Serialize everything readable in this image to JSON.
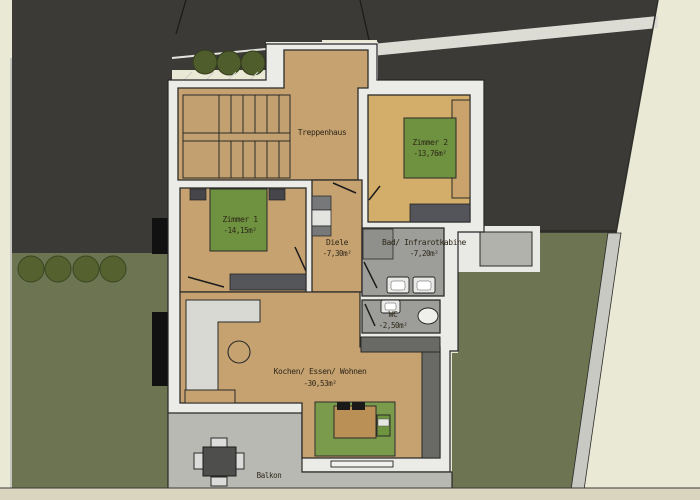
{
  "plan": {
    "type": "architectural floor plan, top-down site view",
    "rooms": [
      {
        "name": "Treppenhaus",
        "area": ""
      },
      {
        "name": "Zimmer 2",
        "area": "-13,76m²"
      },
      {
        "name": "Zimmer 1",
        "area": "-14,15m²"
      },
      {
        "name": "Diele",
        "area": "-7,30m²"
      },
      {
        "name": "Bad/ Infrarotkabine",
        "area": "-7,20m²"
      },
      {
        "name": "WC",
        "area": "-2,50m²"
      },
      {
        "name": "Kochen/ Essen/ Wohnen",
        "area": "-30,53m²"
      },
      {
        "name": "Balkon",
        "area": ""
      }
    ],
    "colors": {
      "background": "#eae9d5",
      "neighbor_building": "#3b3a36",
      "lawn": "#6c7452",
      "tree": "#4f5c2c",
      "wood_floor": "#c6a271",
      "bedroom2_floor": "#d3ae6a",
      "bath_gray": "#9d9e9a",
      "wall_white": "#ebebe7",
      "bed_rug_green": "#719341",
      "sofa_rug_green": "#7a9b4b",
      "terrace_gray": "#b9b9b3",
      "path_gray": "#c9c9c3",
      "dark_furniture": "#55565a",
      "counter_gray": "#d9d9d4",
      "dark_counter": "#696a66",
      "outline": "#29292a"
    }
  }
}
